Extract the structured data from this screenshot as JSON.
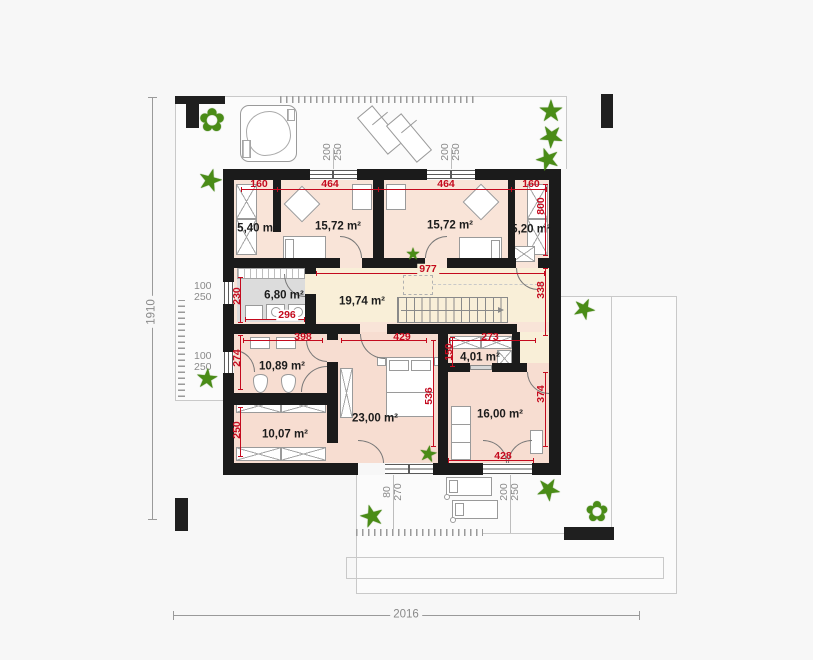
{
  "plan": {
    "overall": {
      "width": "2016",
      "height": "1910"
    },
    "rooms": {
      "r540": "5,40 m²",
      "r1572a": "15,72 m²",
      "r1572b": "15,72 m²",
      "r520": "5,20 m²",
      "r680": "6,80 m²",
      "r1974": "19,74 m²",
      "r1089": "10,89 m²",
      "r401": "4,01 m²",
      "r2300": "23,00 m²",
      "r1007": "10,07 m²",
      "r1600": "16,00 m²"
    },
    "red_dims": {
      "a160": "160",
      "a464": "464",
      "b464": "464",
      "b160": "160",
      "v800": "800",
      "h977": "977",
      "v338": "338",
      "v230": "230",
      "h296": "296",
      "h398": "398",
      "v274": "274",
      "h429": "429",
      "h273": "273",
      "v150": "150",
      "v250": "250",
      "v536": "536",
      "v374": "374",
      "h428": "428"
    },
    "window_dims": {
      "top1": [
        "200",
        "250"
      ],
      "top2": [
        "200",
        "250"
      ],
      "left1": [
        "100",
        "250"
      ],
      "left2": [
        "100",
        "250"
      ],
      "bottom1": [
        "80",
        "270"
      ],
      "bottom2": [
        "200",
        "250"
      ]
    },
    "colors": {
      "wall": "#1b1b1b",
      "room_fill": "#f9e4d8",
      "room_fill_dark": "#f7ddd1",
      "hall_fill": "#f9efd8",
      "utility_fill": "#dcdcdc",
      "dim_red": "#c40a1e",
      "dim_gray": "#8a8a8a",
      "plant_green": "#4a8c17",
      "terrace_line": "#c9c9c9"
    }
  },
  "icons": {
    "plant_star": "★",
    "plant_flower": "✿"
  }
}
